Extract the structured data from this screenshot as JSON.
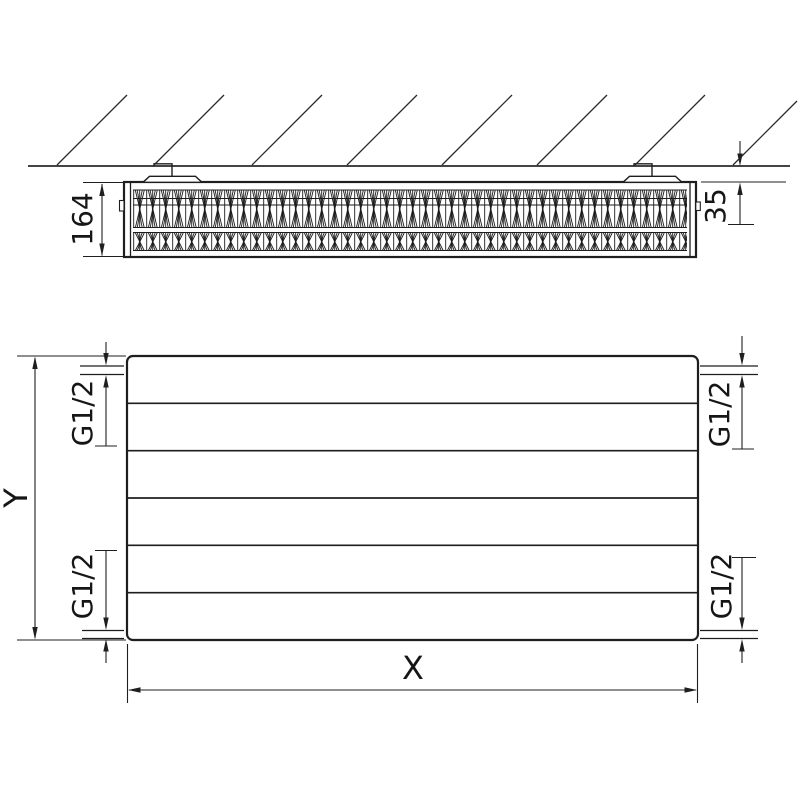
{
  "drawing": {
    "type": "radiator technical drawing, side section on wall + front elevation",
    "colors": {
      "line": "#1f1f1f",
      "background": "#ffffff"
    },
    "side_view": {
      "depth_label": "164",
      "wall_gap_label": "35"
    },
    "front_view": {
      "height_label": "Y",
      "width_label": "X",
      "conn_top_left": "G1/2",
      "conn_top_right": "G1/2",
      "conn_bottom_left": "G1/2",
      "conn_bottom_right": "G1/2"
    }
  }
}
